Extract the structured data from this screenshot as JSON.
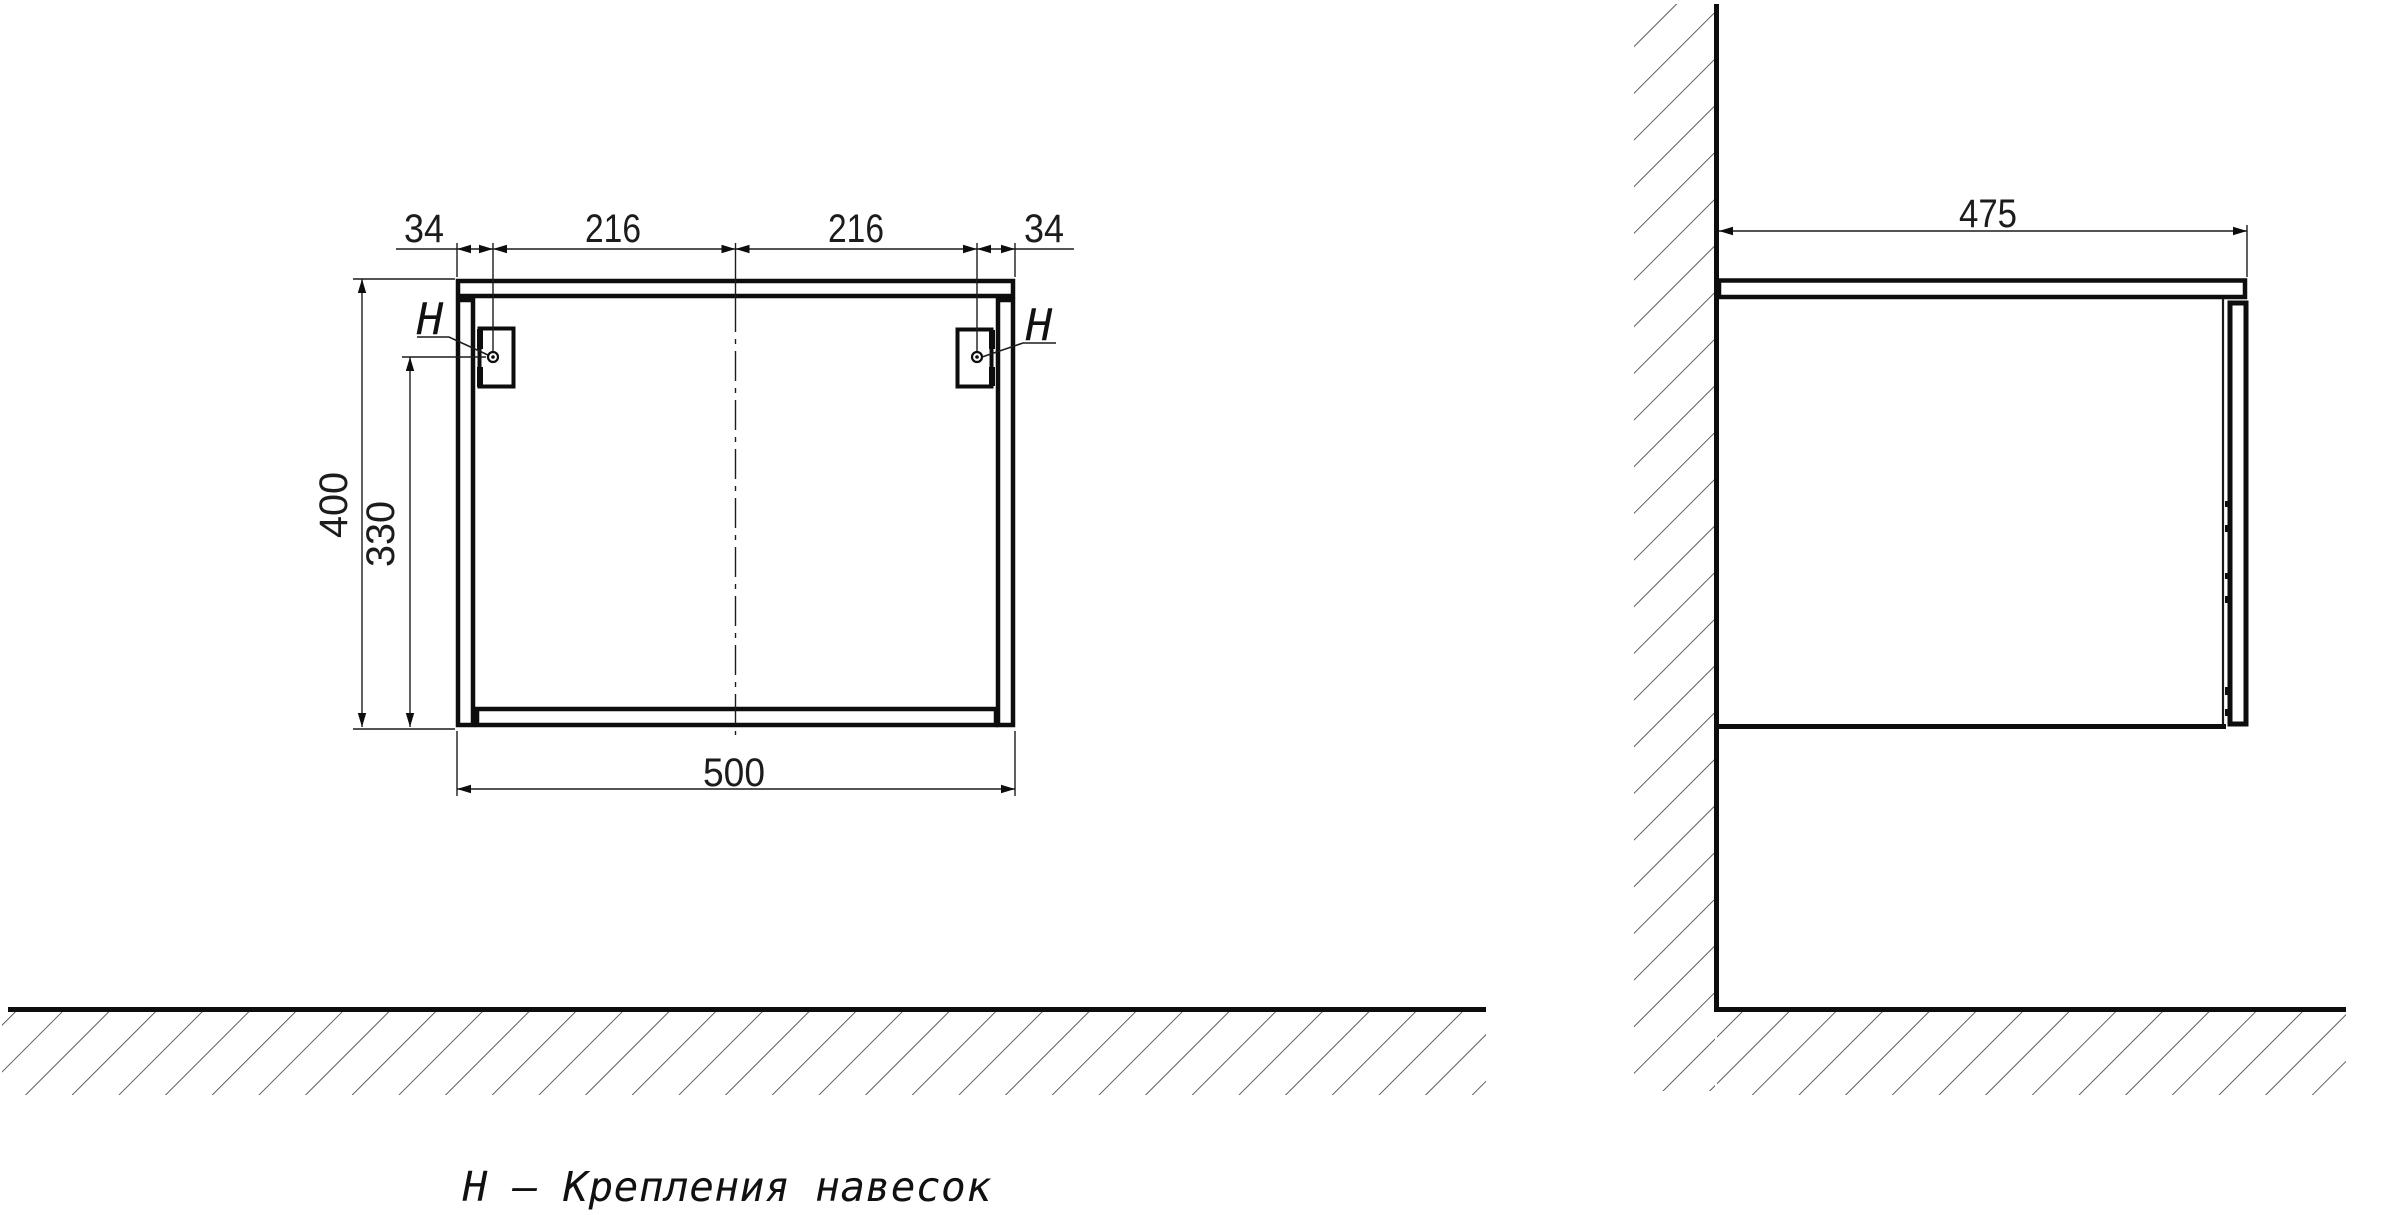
{
  "caption": "Н – Крепления навесок",
  "front_view": {
    "top_dims": [
      "34",
      "216",
      "216",
      "34"
    ],
    "height_dim": "400",
    "hanger_height_dim": "330",
    "width_dim": "500",
    "hanger_label_left": "Н",
    "hanger_label_right": "Н"
  },
  "side_view": {
    "depth_dim": "475"
  },
  "colors": {
    "line": "#1c1c1c",
    "background": "#ffffff"
  }
}
